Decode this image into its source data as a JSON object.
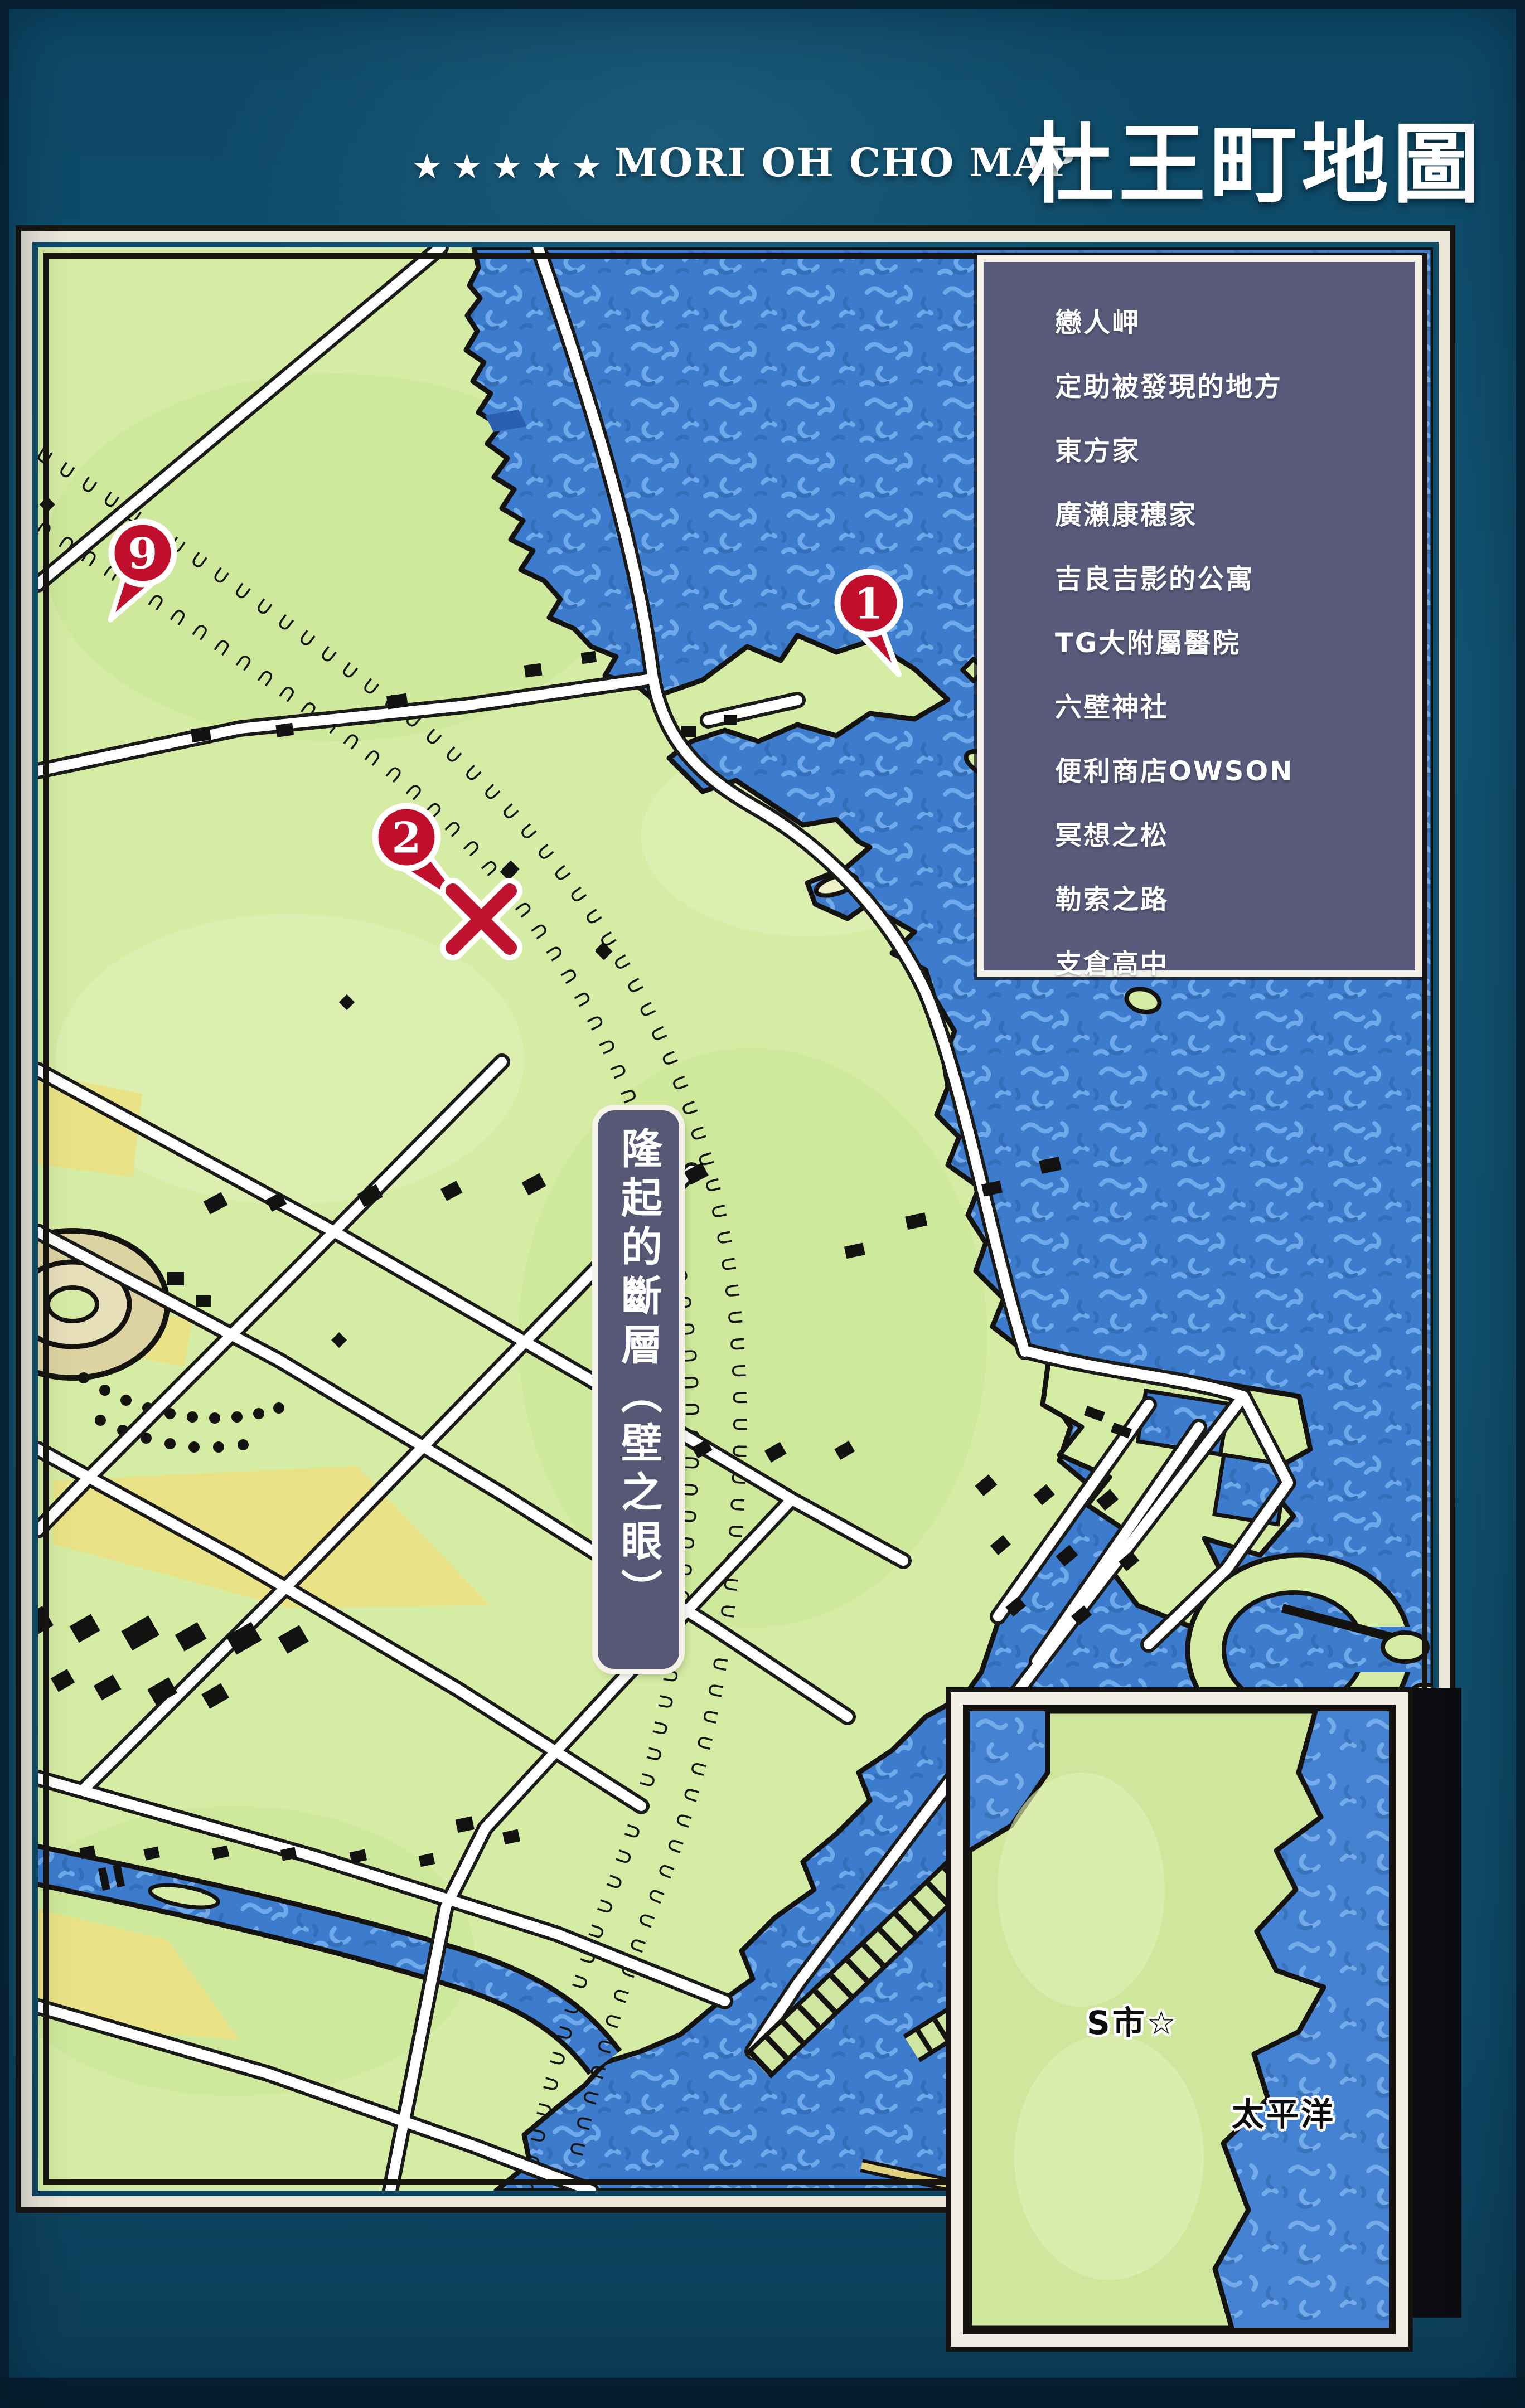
{
  "title": {
    "stars": "★★★★★",
    "en": "MORI OH CHO MAP",
    "zh": "杜王町地圖"
  },
  "legend": {
    "items": [
      "戀人岬",
      "定助被發現的地方",
      "東方家",
      "廣瀨康穗家",
      "吉良吉影的公寓",
      "TG大附屬醫院",
      "六壁神社",
      "便利商店OWSON",
      "冥想之松",
      "勒索之路",
      "支倉高中"
    ]
  },
  "fault_label": "隆起的斷層（壁之眼）",
  "markers": [
    {
      "number": "1"
    },
    {
      "number": "2"
    },
    {
      "number": "9"
    }
  ],
  "inset": {
    "city_label": "S市☆",
    "ocean_label": "太平洋"
  },
  "colors": {
    "page_teal": "#10506d",
    "sea_blue": "#3d7ccd",
    "land_green": "#d5eca4",
    "field_yellow": "#e9e286",
    "legend_slate": "#5a5a7a",
    "frame_cream": "#ece7db",
    "marker_red": "#bf0f2c",
    "ink_black": "#15130f"
  }
}
